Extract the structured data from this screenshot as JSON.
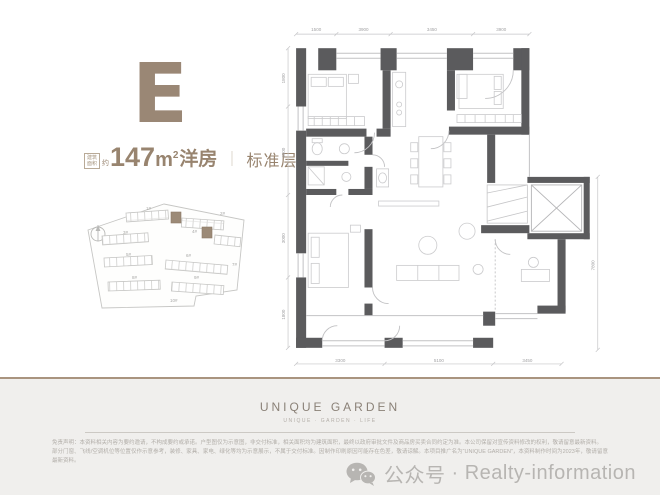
{
  "colors": {
    "accent": "#9a8775",
    "wall": "#5b5b5d",
    "footer_band": "#f0efed",
    "footer_rule": "#a9947f",
    "muted_text": "#b2aea9"
  },
  "unit": {
    "letter": "E",
    "area_box_line1": "建筑",
    "area_box_line2": "面积",
    "approx": "约",
    "area_value": "147",
    "area_unit": "m",
    "area_sup": "2",
    "area_type": "洋房",
    "divider": "｜",
    "floor_label": "标准层"
  },
  "site_plan": {
    "building_labels": [
      "1#",
      "2#",
      "3#",
      "4#",
      "5#",
      "6#",
      "7#",
      "8#",
      "9#",
      "10#"
    ],
    "highlight_color": "#9c8a77"
  },
  "floor_plan": {
    "dims_top": [
      "1500",
      "3900",
      "3450",
      "3900"
    ],
    "dims_left": [
      "1800",
      "4500",
      "3000",
      "1800"
    ],
    "dims_bottom": [
      "3300",
      "5100",
      "3450"
    ],
    "dims_right": [
      "7800"
    ]
  },
  "footer": {
    "brand": "UNIQUE GARDEN",
    "tagline": "UNIQUE · GARDEN · LIFE",
    "disclaimer_line1": "免责声明：本资料相关内容为要约邀请，不构成要约或承诺。户型图仅为示意图，非交付标准，相关面积均为建筑面积，最终以政府审批文件及商品房买卖合同约定为准。本公司保留对宣传资料修改的权利，敬请留意最新资料。",
    "disclaimer_line2": "部分门窗、飞线/空调机位等位置仅作示意参考，装修、家具、家电、绿化等均为示意展示，不属于交付标准。因制作印刷原因可能存在色差，敬请谅解。本项目推广名为“UNIQUE GARDEN”，本资料制作时间为2023年，敬请留意最新资料。",
    "wechat_label": "公众号",
    "separator": "·",
    "account": "Realty-information"
  }
}
